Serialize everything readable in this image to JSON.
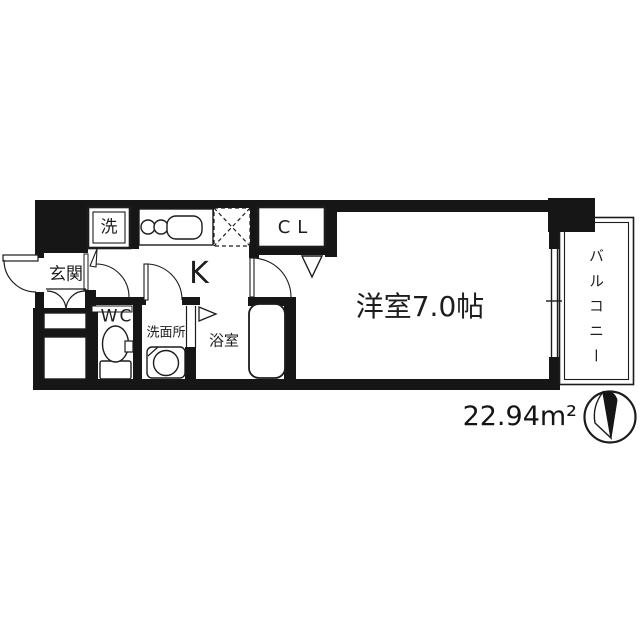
{
  "floorplan": {
    "labels": {
      "entrance": "玄関",
      "washer": "洗",
      "kitchen": "K",
      "closet": "CL",
      "wc": "WC",
      "washroom": "洗面所",
      "bathroom": "浴室",
      "main_room": "洋室7.0帖",
      "balcony": "バルコニー"
    },
    "area_label": "22.94m²",
    "colors": {
      "wall": "#161616",
      "line": "#1c1c1c",
      "background": "#ffffff"
    }
  }
}
